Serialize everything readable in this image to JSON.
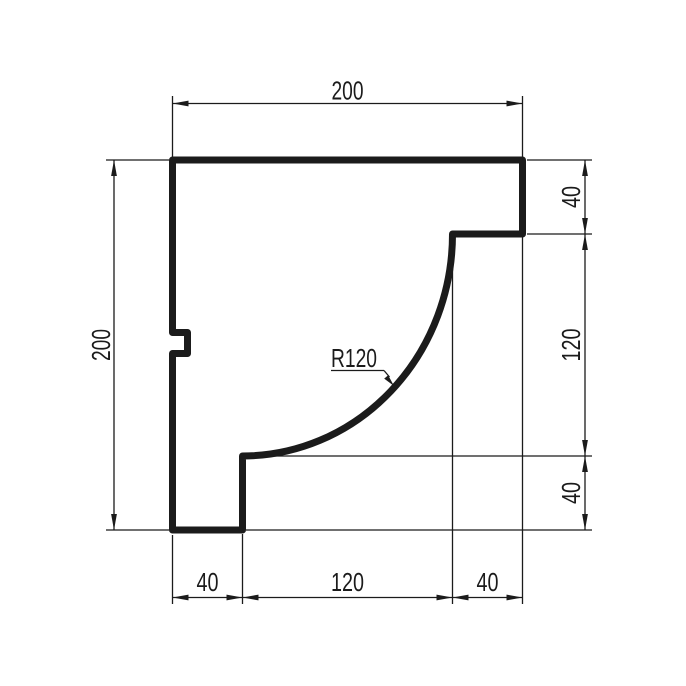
{
  "canvas": {
    "width": 686,
    "height": 686,
    "background": "#ffffff",
    "line_color": "#1b1b1b"
  },
  "dimensions": {
    "top_width": {
      "label": "200",
      "value": 200
    },
    "left_height": {
      "label": "200",
      "value": 200
    },
    "right_segments": [
      {
        "label": "40",
        "value": 40
      },
      {
        "label": "120",
        "value": 120
      },
      {
        "label": "40",
        "value": 40
      }
    ],
    "bottom_segments": [
      {
        "label": "40",
        "value": 40
      },
      {
        "label": "120",
        "value": 120
      },
      {
        "label": "40",
        "value": 40
      }
    ],
    "radius_callout": {
      "label": "R120",
      "value": 120
    }
  }
}
